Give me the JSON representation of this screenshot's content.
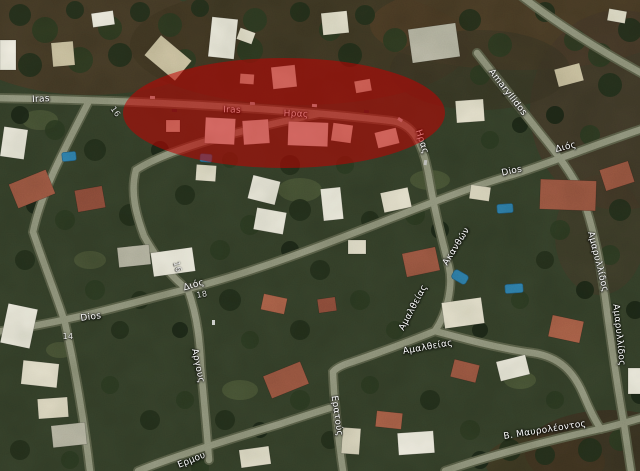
{
  "map": {
    "view_type": "satellite",
    "street_labels": [
      {
        "id": "iras-latin-west",
        "text": "Iras"
      },
      {
        "id": "iras-latin-center",
        "text": "Iras"
      },
      {
        "id": "iras-greek-center",
        "text": "Ηρας"
      },
      {
        "id": "iras-greek-south",
        "text": "Ηρας"
      },
      {
        "id": "amaryllidos-latin",
        "text": "Amaryllidos"
      },
      {
        "id": "dios-greek-east",
        "text": "Διός"
      },
      {
        "id": "dios-latin-east",
        "text": "Dios"
      },
      {
        "id": "dios-latin-west",
        "text": "Dios"
      },
      {
        "id": "dios-greek-west",
        "text": "Διός"
      },
      {
        "id": "house-number-18",
        "text": "18"
      },
      {
        "id": "house-number-14",
        "text": "14"
      },
      {
        "id": "house-number-16-north",
        "text": "16"
      },
      {
        "id": "house-number-16-mid",
        "text": "16"
      },
      {
        "id": "argous",
        "text": "Αργους"
      },
      {
        "id": "amaltheias-horizontal",
        "text": "Αμαλθείας"
      },
      {
        "id": "amaltheias-diagonal",
        "text": "Αμαλθείας"
      },
      {
        "id": "akanthon",
        "text": "Ακανθών"
      },
      {
        "id": "amaryllidos-greek-north",
        "text": "Αμαρυλλίδος"
      },
      {
        "id": "amaryllidos-greek-south",
        "text": "Αμαρυλλίδος"
      },
      {
        "id": "eratous",
        "text": "Ερατούς"
      },
      {
        "id": "mavroleontos",
        "text": "Β. Μαυρολέοντος"
      },
      {
        "id": "ermou",
        "text": "Ερμου"
      }
    ],
    "highlight": {
      "shape": "ellipse",
      "fill": "rgba(193,0,0,0.55)"
    },
    "palette": {
      "terrain_green": "#35402a",
      "scrub_brown": "#493b27",
      "road_gray": "#92967f",
      "building_light": "#e7e2cf",
      "roof_red": "#9c5742",
      "pool_blue": "#2e7fae",
      "label_white": "#fdfdfd"
    }
  }
}
